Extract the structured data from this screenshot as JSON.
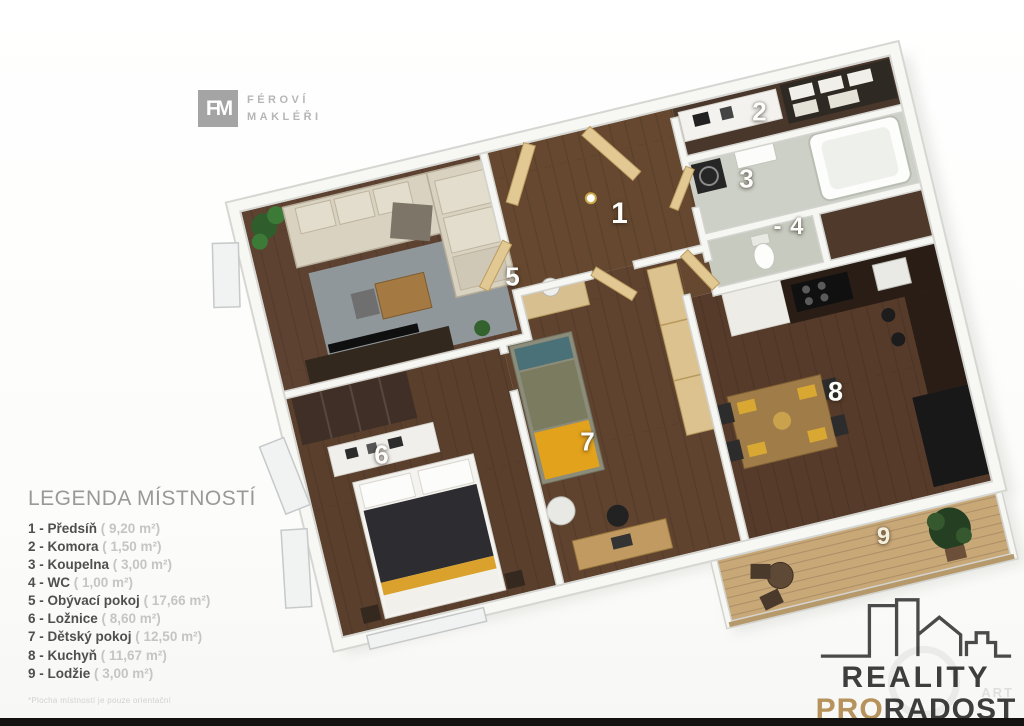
{
  "branding": {
    "fm_logo": {
      "monogram": "FM",
      "line1": "FÉROVÍ",
      "line2": "MAKLÉŘI"
    },
    "agency_logo": {
      "word1": "REALITY",
      "word2_accent": "PRO",
      "word2_rest": "RADOST"
    },
    "watermark": "ART"
  },
  "legend": {
    "title": "LEGENDA MÍSTNOSTÍ",
    "items": [
      {
        "label": "1 - Předsíň",
        "area": "( 9,20 m²)"
      },
      {
        "label": "2 - Komora",
        "area": "( 1,50 m²)"
      },
      {
        "label": "3 - Koupelna",
        "area": "( 3,00 m²)"
      },
      {
        "label": "4 - WC",
        "area": "( 1,00 m²)"
      },
      {
        "label": "5 - Obývací pokoj",
        "area": "( 17,66 m²)"
      },
      {
        "label": "6 - Ložnice",
        "area": "( 8,60 m²)"
      },
      {
        "label": "7 - Dětský pokoj",
        "area": "( 12,50 m²)"
      },
      {
        "label": "8 - Kuchyň",
        "area": "( 11,67 m²)"
      },
      {
        "label": "9 - Lodžie",
        "area": "( 3,00 m²)"
      }
    ],
    "footnote": "*Plocha místností je pouze orientační"
  },
  "plan": {
    "labels": [
      {
        "text": "1"
      },
      {
        "text": "2"
      },
      {
        "text": "3"
      },
      {
        "text": "- 4"
      },
      {
        "text": "5"
      },
      {
        "text": "6"
      },
      {
        "text": "7"
      },
      {
        "text": "8"
      },
      {
        "text": "9"
      }
    ]
  },
  "colors": {
    "accent_gold": "#b6925c",
    "furniture_yellow": "#e2a21c",
    "wood_floor": "#5d4231",
    "wall_white": "#f6f6f3"
  }
}
